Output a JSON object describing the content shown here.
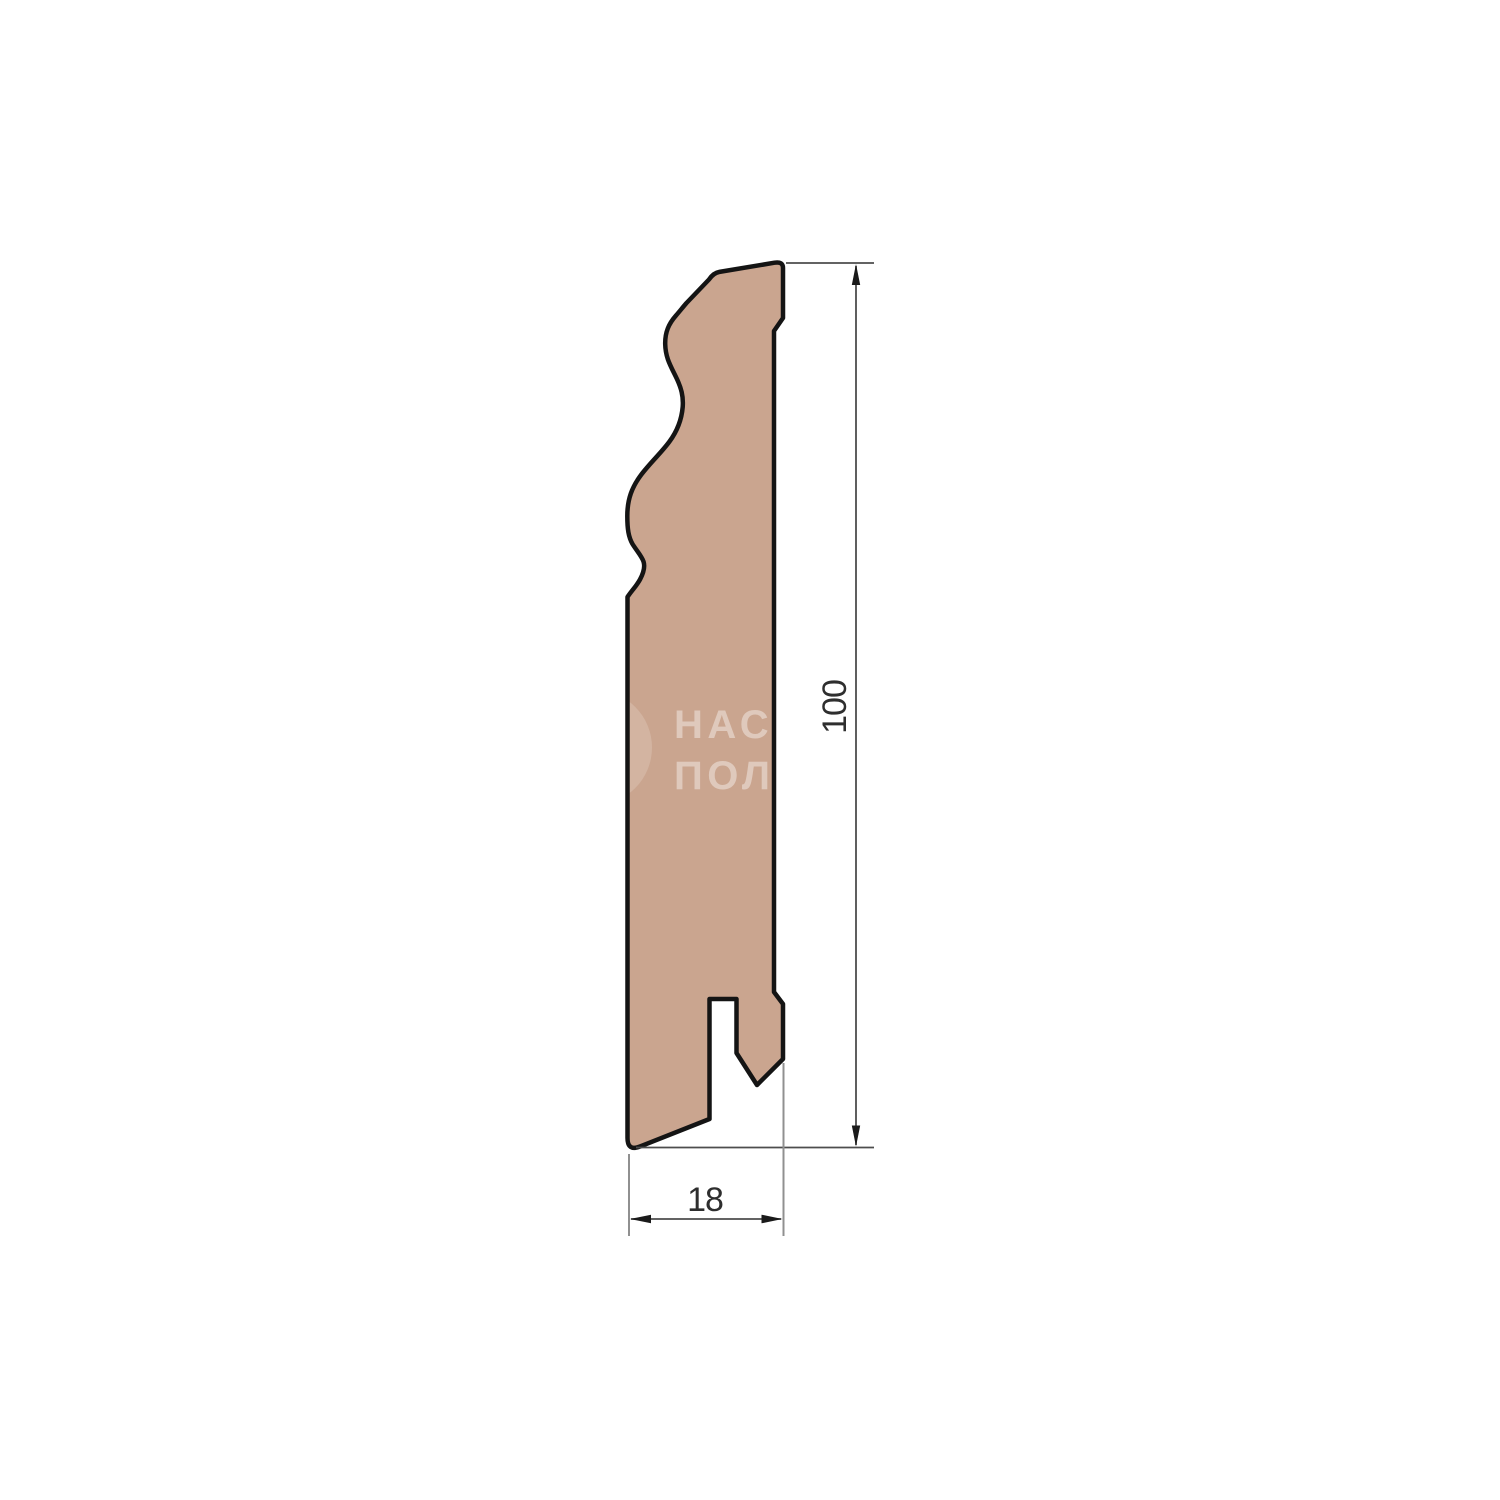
{
  "drawing": {
    "height_label": "100",
    "width_label": "18",
    "profile_fill": "#CAA58F",
    "outline_color": "#141414",
    "dim_line_color": "#4d4d4d",
    "ext_line_color": "#909090",
    "arrow_color": "#1a1a1a",
    "dim_text_color": "#2e2e2e",
    "background": "#ffffff"
  },
  "watermark": {
    "line1": "НАС",
    "line2": "ПОЛ",
    "text_color": "rgba(255,255,255,0.40)",
    "circle_color": "rgba(255,255,255,0.17)"
  }
}
